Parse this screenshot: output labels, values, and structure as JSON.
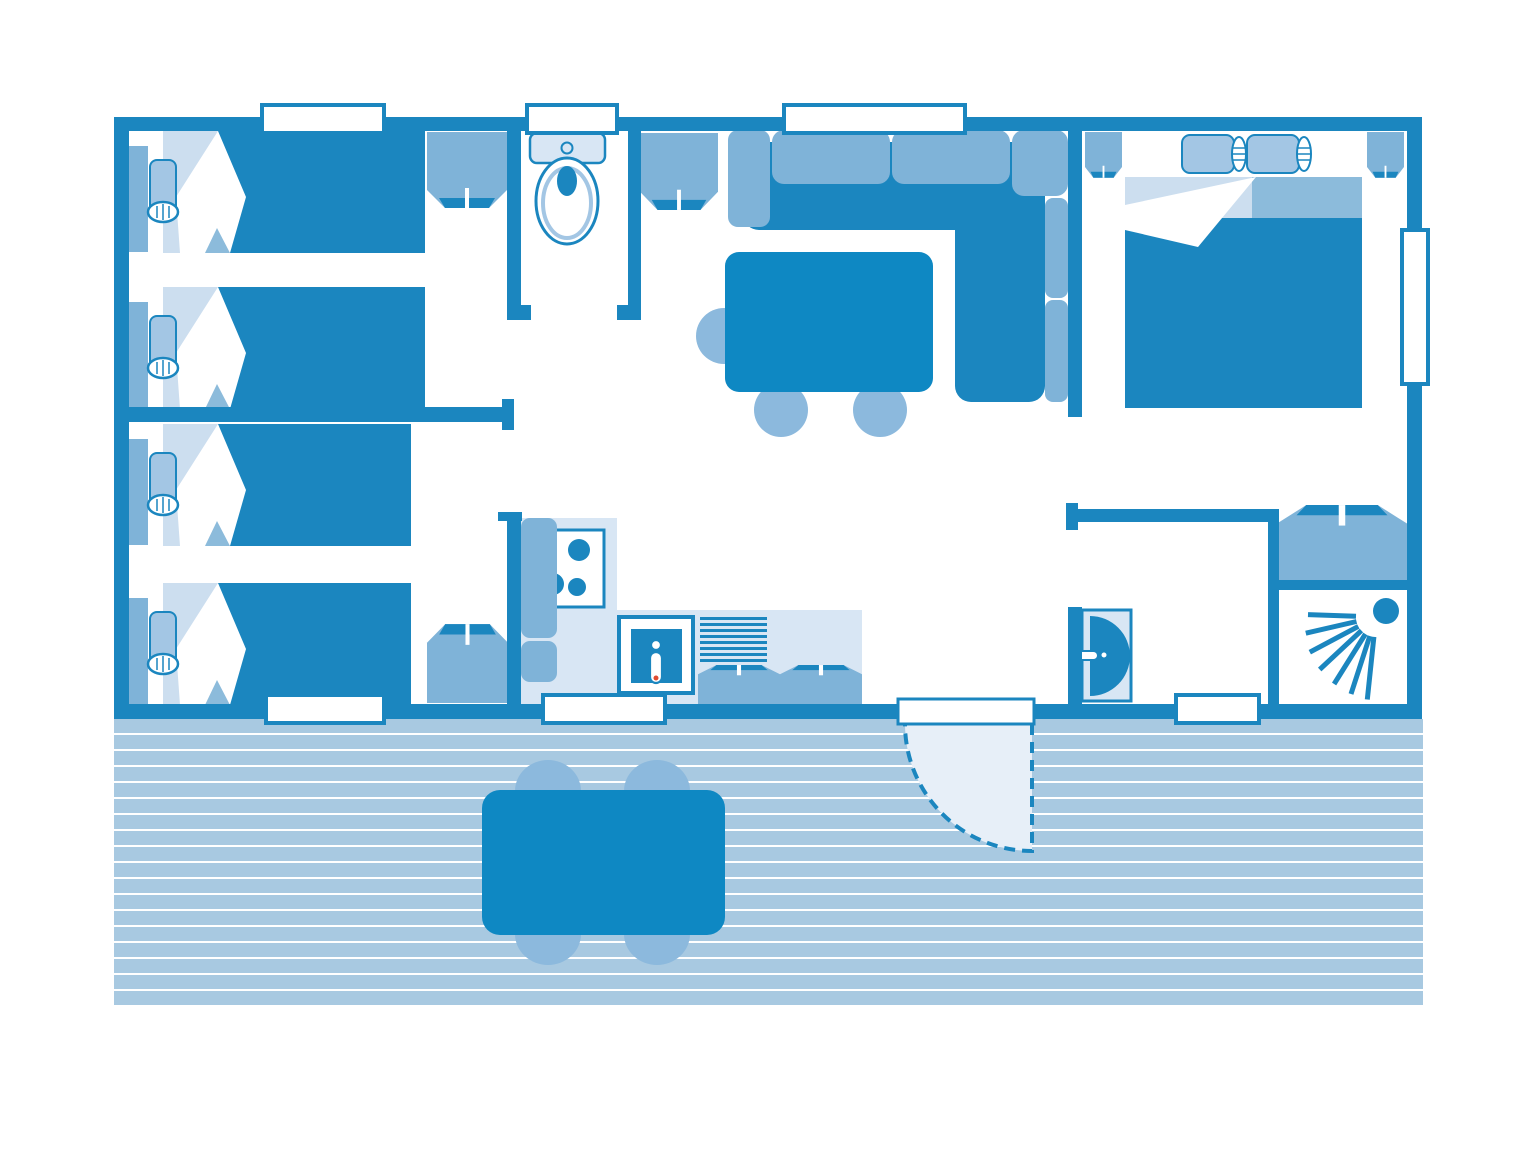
{
  "palette": {
    "wall": "#1b86bf",
    "dark": "#1b86bf",
    "table": "#0e88c3",
    "med": "#7fb3d8",
    "chair": "#8cb9dd",
    "pillow": "#a3c6e4",
    "pale": "#d8e6f4",
    "foldl": "#ccdeef",
    "foldm": "#8cbbdb",
    "plank": "#a8c9e1",
    "swing": "#e7eff8",
    "red": "#e04b30",
    "paper": "#ffffff"
  },
  "terrace": {
    "planks": 18,
    "x": 114,
    "y": 719,
    "width": 1309,
    "pitch": 16,
    "plank_height": 14
  },
  "kitchen": {
    "drainer_lines": 8,
    "drainer": {
      "x": 700,
      "y": 617,
      "width": 67,
      "thickness": 3,
      "gap": 6
    },
    "burners": [
      [
        579,
        550,
        11
      ],
      [
        577,
        587,
        9
      ],
      [
        553,
        584,
        11
      ]
    ]
  },
  "shower": {
    "origin": [
      1376,
      617
    ],
    "rays": [
      {
        "angle": 182,
        "inner": 20,
        "outer": 68
      },
      {
        "angle": 167,
        "inner": 20,
        "outer": 72
      },
      {
        "angle": 152,
        "inner": 20,
        "outer": 75
      },
      {
        "angle": 137,
        "inner": 20,
        "outer": 77
      },
      {
        "angle": 122,
        "inner": 20,
        "outer": 79
      },
      {
        "angle": 108,
        "inner": 20,
        "outer": 81
      },
      {
        "angle": 96,
        "inner": 20,
        "outer": 83
      }
    ],
    "head": [
      1386,
      611,
      13
    ]
  },
  "inventory": {
    "rooms": [
      {
        "name": "bedroom-1",
        "furniture": [
          "single-bed",
          "single-bed",
          "wardrobe"
        ]
      },
      {
        "name": "bedroom-2",
        "furniture": [
          "single-bed",
          "single-bed",
          "wardrobe"
        ]
      },
      {
        "name": "wc",
        "furniture": [
          "toilet"
        ]
      },
      {
        "name": "living-room",
        "furniture": [
          "corner-sofa",
          "dining-table",
          "chairs"
        ]
      },
      {
        "name": "kitchen",
        "furniture": [
          "fridge",
          "hob",
          "sink",
          "drainer",
          "counter",
          "storage"
        ]
      },
      {
        "name": "master-bedroom",
        "furniture": [
          "double-bed",
          "nightstand",
          "nightstand",
          "window"
        ]
      },
      {
        "name": "shower-room",
        "furniture": [
          "shower",
          "wardrobe"
        ]
      },
      {
        "name": "terrace",
        "furniture": [
          "outdoor-table",
          "chairs",
          "entrance-door-swing"
        ]
      }
    ]
  }
}
